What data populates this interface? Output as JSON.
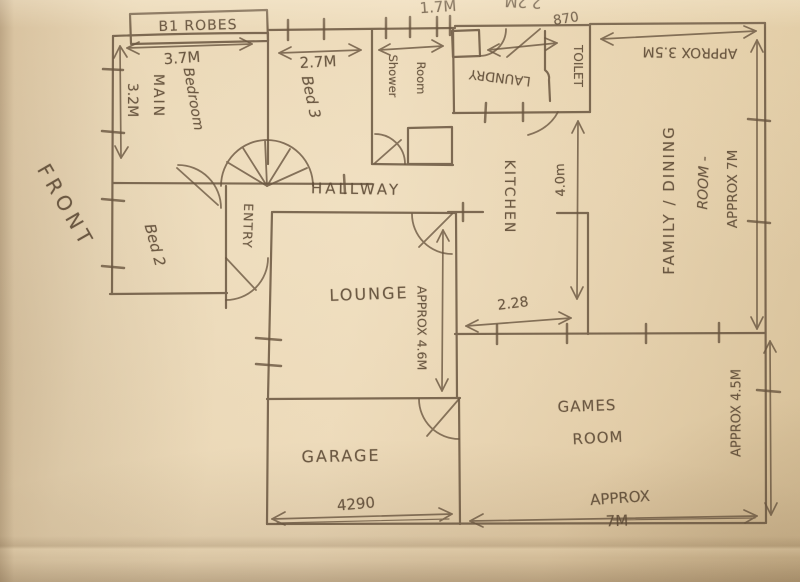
{
  "photo": {
    "palette": {
      "paper": "#e8d5b3",
      "pencil": "#6a5640"
    }
  },
  "plan": {
    "front_label": "FRONT",
    "top_dimensions": {
      "d1": "1.7M",
      "d2": "2.2M",
      "d3": "870"
    },
    "rooms": {
      "main_bedroom": {
        "robes_box": "B1 ROBES",
        "name_line1": "MAIN",
        "name_line2": "Bedroom",
        "width": "3.7M",
        "depth": "3.2M"
      },
      "bed3": {
        "name": "Bed 3",
        "width": "2.7M"
      },
      "shower_room": {
        "name_line1": "Shower",
        "name_line2": "Room"
      },
      "laundry": {
        "name": "LAUNDRY"
      },
      "toilet": {
        "name": "TOILET"
      },
      "hallway": {
        "name": "HALLWAY"
      },
      "entry": {
        "name": "ENTRY"
      },
      "bed2": {
        "name": "Bed 2"
      },
      "kitchen": {
        "name": "KITCHEN",
        "depth": "4.0m",
        "width": "2.28"
      },
      "family_dining": {
        "name_line1": "FAMILY / DINING",
        "name_line2": "ROOM -",
        "name_line3": "APPROX 7M",
        "width": "APPROX 3.5M"
      },
      "lounge": {
        "name": "LOUNGE",
        "depth": "APPROX 4.6M"
      },
      "garage": {
        "name": "GARAGE",
        "width": "4290"
      },
      "games_room": {
        "name_line1": "GAMES",
        "name_line2": "ROOM",
        "width_line1": "APPROX",
        "width_line2": "7M",
        "depth": "APPROX 4.5M"
      }
    }
  }
}
